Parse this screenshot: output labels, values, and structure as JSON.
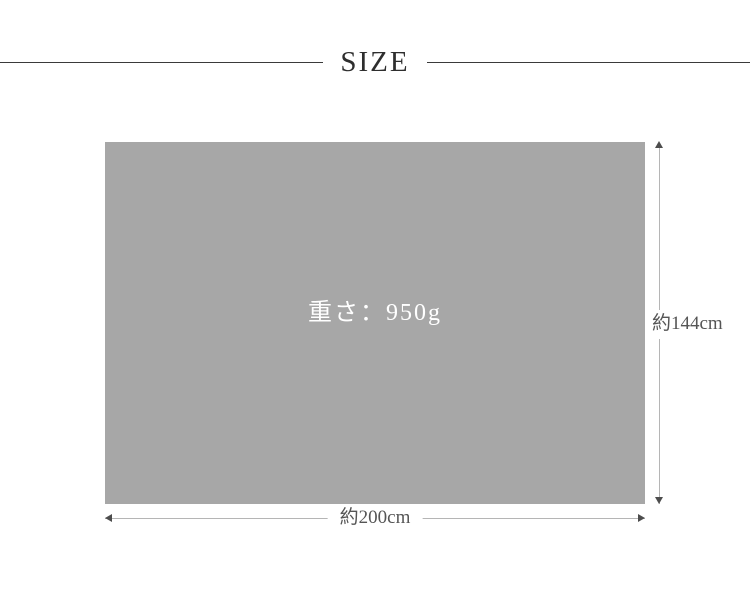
{
  "header": {
    "title": "SIZE"
  },
  "diagram": {
    "weight_label": "重さ：950g",
    "height_label": "約144cm",
    "width_label": "約200cm"
  },
  "colors": {
    "bg": "#ffffff",
    "rect_fill": "#a7a7a7",
    "title_color": "#2e2e2e",
    "rule_color": "#3a3a3a",
    "dim_line": "#b5b5b5",
    "arrow_color": "#4d4d4d",
    "dim_text": "#555555",
    "weight_text": "#ffffff"
  }
}
